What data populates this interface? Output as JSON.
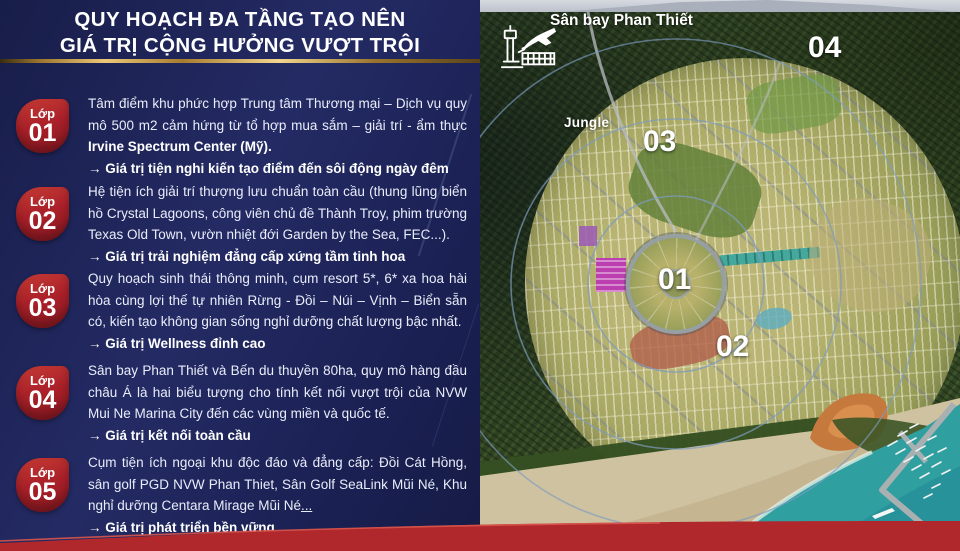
{
  "header": {
    "title_line1": "QUY HOẠCH ĐA TẦNG TẠO NÊN",
    "title_line2": "GIÁ TRỊ CỘNG HƯỞNG VƯỢT TRỘI"
  },
  "layers": [
    {
      "badge_label": "Lớp",
      "badge_number": "01",
      "text_regular": "Tâm điểm khu phức hợp Trung tâm Thương mại – Dịch vụ quy mô 500 m2 cảm hứng từ tổ hợp mua sắm – giải trí - ẩm thực ",
      "text_bold": "Irvine Spectrum Center (Mỹ).",
      "text_underline": "",
      "conclusion": "→ Giá trị tiện nghi kiến tạo điểm đến sôi động ngày đêm"
    },
    {
      "badge_label": "Lớp",
      "badge_number": "02",
      "text_regular": "Hệ tiện ích giải trí thượng lưu chuẩn toàn cầu (thung lũng biển hồ Crystal Lagoons, công viên chủ đề Thành Troy, phim trường Texas Old Town, vườn nhiệt đới Garden by the Sea, FEC...).",
      "text_bold": "",
      "text_underline": "",
      "conclusion": "→ Giá trị trải nghiệm đẳng cấp xứng tầm tinh hoa"
    },
    {
      "badge_label": "Lớp",
      "badge_number": "03",
      "text_regular": "Quy hoạch sinh thái thông minh, cụm resort 5*, 6* xa hoa hài hòa cùng lợi thế tự nhiên Rừng - Đồi – Núi – Vịnh – Biển sẵn có, kiến tạo không gian sống nghỉ dưỡng chất lượng bậc nhất.",
      "text_bold": "",
      "text_underline": "",
      "conclusion": "→ Giá trị Wellness đỉnh cao"
    },
    {
      "badge_label": "Lớp",
      "badge_number": "04",
      "text_regular": "Sân bay Phan Thiết và Bến du thuyền 80ha, quy mô hàng đầu châu Á là hai biểu tượng cho tính kết nối vượt trội của NVW Mui Ne Marina City đến các vùng miền và quốc tế.",
      "text_bold": "",
      "text_underline": "",
      "conclusion": "→ Giá trị kết nối toàn cầu"
    },
    {
      "badge_label": "Lớp",
      "badge_number": "05",
      "text_regular": "Cụm tiện ích ngoại khu độc đáo và đẳng cấp: Đồi Cát Hồng, sân golf PGD NVW Phan Thiet, Sân Golf SeaLink Mũi Né, Khu nghỉ dưỡng Centara Mirage Mũi Né",
      "text_bold": "",
      "text_underline": "...",
      "conclusion": "→ Giá trị phát triển bền vững"
    }
  ],
  "map": {
    "airport_label": "Sân bay Phan Thiết",
    "jungle_label": "Jungle",
    "zone_numbers": [
      "01",
      "02",
      "03",
      "04"
    ],
    "icons": [
      {
        "name": "airport-icon"
      }
    ]
  },
  "colors": {
    "panel_navy": "#1e2457",
    "badge_red": "#ab2029",
    "ribbon_red": "#b1282c",
    "gold_divider": "#ecc878",
    "map_forest": "#304322",
    "map_plan_olive": "#a3a45f",
    "map_sea_teal": "#2f9fa0",
    "map_sand": "#cfc2a0",
    "zone_label_white": "#ffffff"
  }
}
